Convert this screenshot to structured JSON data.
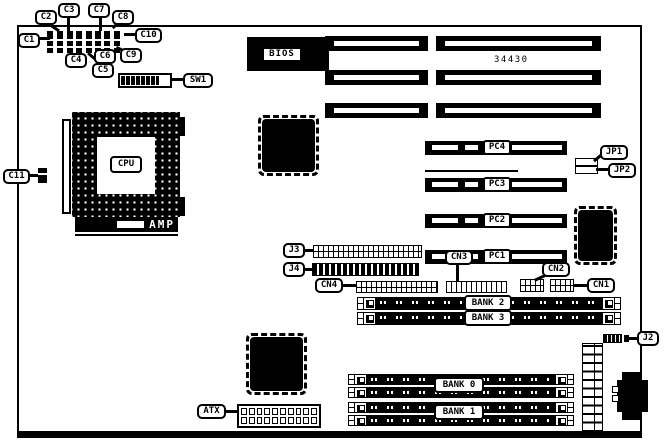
{
  "part_number": "34430",
  "callouts": {
    "c1": "C1",
    "c2": "C2",
    "c3": "C3",
    "c4": "C4",
    "c5": "C5",
    "c6": "C6",
    "c7": "C7",
    "c8": "C8",
    "c9": "C9",
    "c10": "C10",
    "c11": "C11",
    "sw1": "SW1",
    "jp1": "JP1",
    "jp2": "JP2",
    "j2": "J2",
    "j3": "J3",
    "j4": "J4",
    "cn1": "CN1",
    "cn2": "CN2",
    "cn3": "CN3",
    "cn4": "CN4",
    "atx": "ATX"
  },
  "chips": {
    "bios": "BIOS",
    "cpu": "CPU",
    "amp": "AMP"
  },
  "pci_slots": {
    "pc1": "PC1",
    "pc2": "PC2",
    "pc3": "PC3",
    "pc4": "PC4"
  },
  "memory": {
    "bank0": "BANK 0",
    "bank1": "BANK 1",
    "bank2": "BANK 2",
    "bank3": "BANK 3"
  },
  "colors": {
    "ink": "#000000",
    "paper": "#ffffff"
  }
}
